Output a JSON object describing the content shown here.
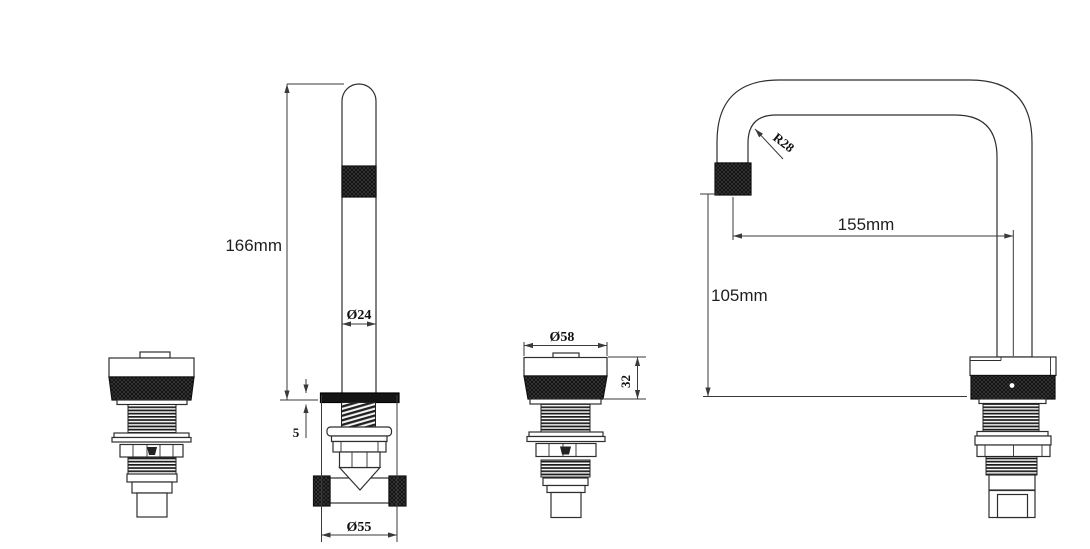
{
  "drawing": {
    "background": "#ffffff",
    "outline_color": "#2e2e2e",
    "dimension_line_color": "#3a3a3a",
    "knurl_fill": "#0f0f0f"
  },
  "dimensions": {
    "spout_height": "166mm",
    "spout_tube_diameter": "Ø24",
    "flange_thickness": "5",
    "flange_diameter": "Ø55",
    "handle_diameter": "Ø58",
    "handle_height": "32",
    "bend_radius": "R28",
    "spout_reach": "155mm",
    "outlet_height": "105mm"
  }
}
